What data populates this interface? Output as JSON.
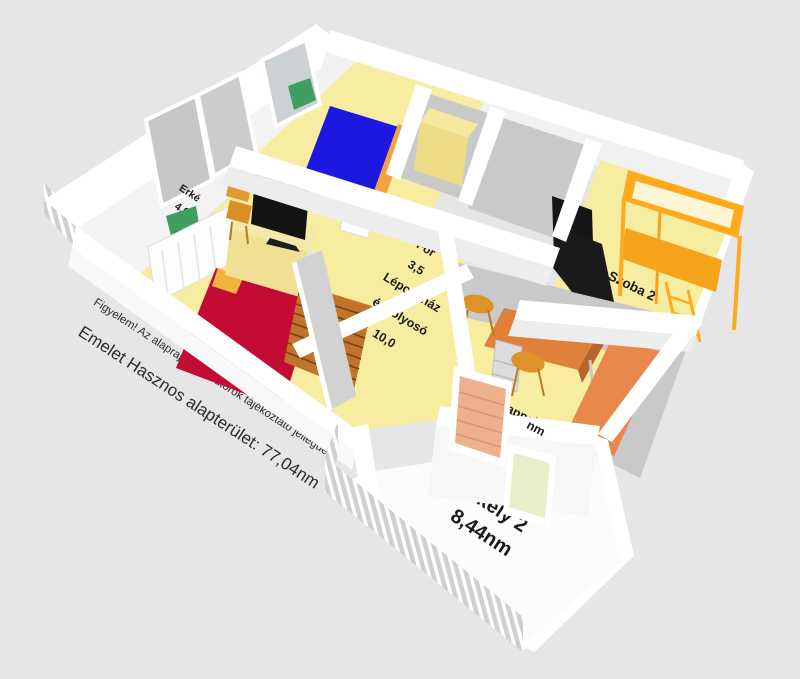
{
  "annotations": {
    "disclaimer": "Figyelem! Az alaprajz és a bútorok tájékoztató jellegüek!",
    "summary": "Emelet Hasznos alapterület: 77,04nm"
  },
  "rooms": {
    "erkely1": {
      "label": "Erké",
      "area": "4,6"
    },
    "szoba1": {
      "label": "Szob",
      "area": "15,79"
    },
    "kisszoba": {
      "label": "For",
      "area": "3,5"
    },
    "lepcsohaz": {
      "line1": "Lépcsőház",
      "line2": "és folyosó",
      "area": "10,0"
    },
    "szoba2": {
      "label": "Szoba 2"
    },
    "nappali": {
      "label": "Nappali 2",
      "area": "nm"
    },
    "erkely2": {
      "label": "Erkély 2",
      "area": "8,44nm"
    }
  },
  "palette": {
    "background": "#e6e6e6",
    "wall": "#ffffff",
    "wall_shadow": "#d2d2d2",
    "floor_yellow": "#f7eda0",
    "floor_gray": "#c9c9c9",
    "bed_blue": "#1c18e0",
    "bed_red": "#c30b34",
    "furniture_orange": "#e0813b",
    "bunk_orange": "#ffaa1e",
    "stairs_brown": "#c0732b",
    "tv_black": "#141414",
    "plant_green": "#3f9f60",
    "blind_salmon": "#edb18d",
    "pane_green": "#eaedca"
  }
}
